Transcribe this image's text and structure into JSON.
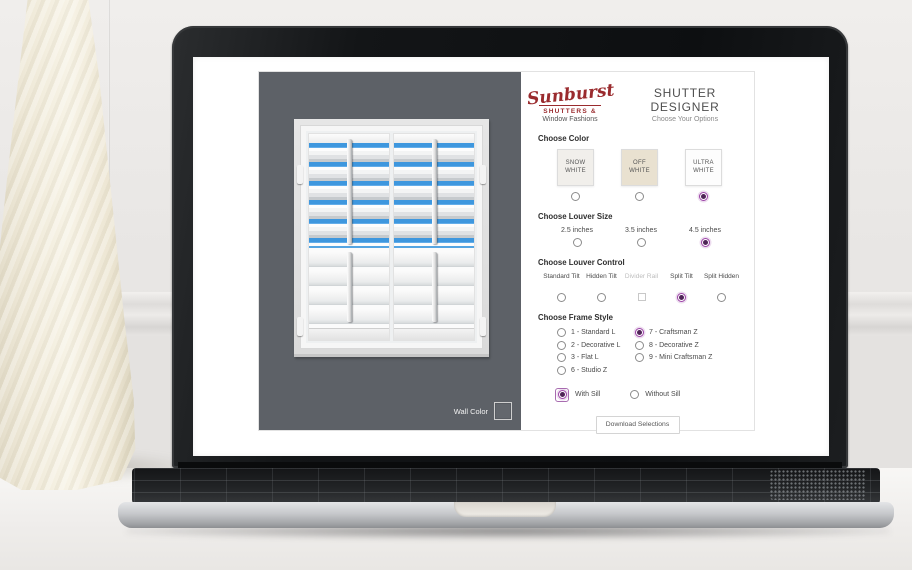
{
  "colors": {
    "accent_purple": "#9c44a6",
    "logo_red": "#9a2b2e",
    "preview_wall": "#5d6167",
    "louver_blue": "#4aa0e4"
  },
  "brand": {
    "logo_script": "Sunburst",
    "logo_sub": "SHUTTERS &",
    "logo_sub2": "Window Fashions",
    "title": "SHUTTER DESIGNER",
    "subtitle": "Choose Your Options"
  },
  "preview": {
    "wall_color_label": "Wall Color"
  },
  "sections": {
    "color": {
      "heading": "Choose Color",
      "options": [
        {
          "label": "SNOW WHITE",
          "swatch": "#f1efeb",
          "selected": false
        },
        {
          "label": "OFF WHITE",
          "swatch": "#e9e1d0",
          "selected": false
        },
        {
          "label": "ULTRA WHITE",
          "swatch": "#fdfdfd",
          "selected": true
        }
      ]
    },
    "louver_size": {
      "heading": "Choose Louver Size",
      "options": [
        {
          "label": "2.5 inches",
          "selected": false
        },
        {
          "label": "3.5 inches",
          "selected": false
        },
        {
          "label": "4.5 inches",
          "selected": true
        }
      ]
    },
    "louver_control": {
      "heading": "Choose Louver Control",
      "options": [
        {
          "label": "Standard Tilt",
          "type": "radio",
          "selected": false,
          "disabled": false
        },
        {
          "label": "Hidden Tilt",
          "type": "radio",
          "selected": false,
          "disabled": false
        },
        {
          "label": "Divider Rail",
          "type": "checkbox",
          "selected": false,
          "disabled": true
        },
        {
          "label": "Split Tilt",
          "type": "radio",
          "selected": true,
          "disabled": false
        },
        {
          "label": "Split Hidden",
          "type": "radio",
          "selected": false,
          "disabled": false
        }
      ]
    },
    "frame_style": {
      "heading": "Choose Frame Style",
      "left": [
        {
          "label": "1 - Standard L",
          "selected": false
        },
        {
          "label": "2 - Decorative L",
          "selected": false
        },
        {
          "label": "3 - Flat L",
          "selected": false
        },
        {
          "label": "6 - Studio Z",
          "selected": false
        }
      ],
      "right": [
        {
          "label": "7 - Craftsman Z",
          "selected": true
        },
        {
          "label": "8 - Decorative Z",
          "selected": false
        },
        {
          "label": "9 - Mini Craftsman Z",
          "selected": false
        }
      ]
    },
    "sill": {
      "options": [
        {
          "label": "With Sill",
          "selected": true
        },
        {
          "label": "Without Sill",
          "selected": false
        }
      ]
    },
    "download_label": "Download Selections"
  }
}
